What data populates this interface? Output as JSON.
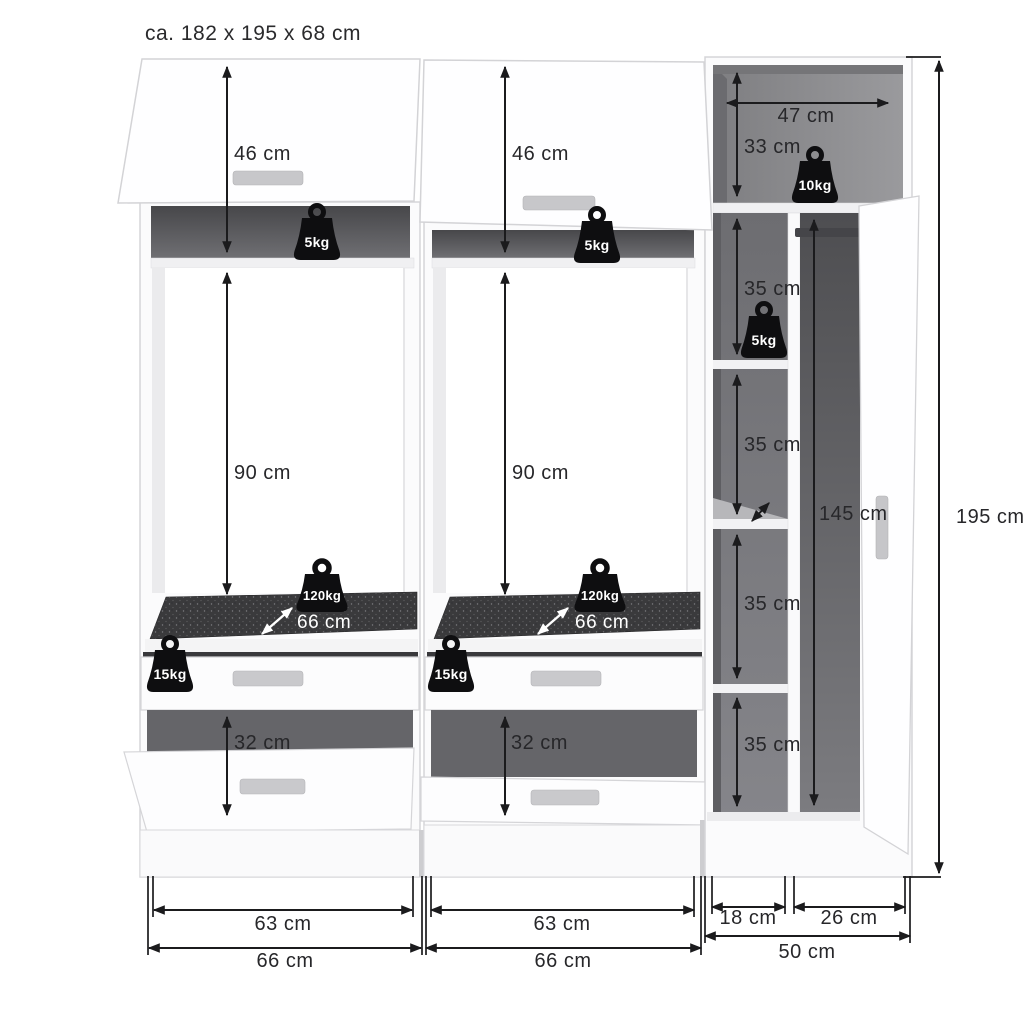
{
  "title": "ca. 182 x 195 x 68 cm",
  "colors": {
    "dimension_line": "#1b1b1d",
    "weight_icon": "#0e0e10",
    "mat_surface": "#3a3a3c"
  },
  "left_unit": {
    "flap_door_height": "46 cm",
    "top_shelf_load": "5kg",
    "interior_height": "90 cm",
    "pullout_shelf_load": "120kg",
    "pullout_shelf_depth": "66 cm",
    "drawer_load": "15kg",
    "open_compartment_height": "32 cm",
    "interior_width": "63 cm",
    "unit_width": "66 cm"
  },
  "middle_unit": {
    "flap_door_height": "46 cm",
    "top_shelf_load": "5kg",
    "interior_height": "90 cm",
    "pullout_shelf_load": "120kg",
    "pullout_shelf_depth": "66 cm",
    "drawer_load": "15kg",
    "open_compartment_height": "32 cm",
    "interior_width": "63 cm",
    "unit_width": "66 cm"
  },
  "right_unit": {
    "top_niche_width": "47 cm",
    "top_niche_height": "33 cm",
    "top_niche_load": "10kg",
    "shelf_load": "5kg",
    "compartment_1_height": "35 cm",
    "compartment_2_height": "35 cm",
    "compartment_3_height": "35 cm",
    "compartment_4_height": "35 cm",
    "hanging_space_height": "145 cm",
    "shelf_column_width": "18 cm",
    "hanging_column_width": "26 cm",
    "unit_width": "50 cm"
  },
  "total": {
    "height": "195 cm"
  }
}
